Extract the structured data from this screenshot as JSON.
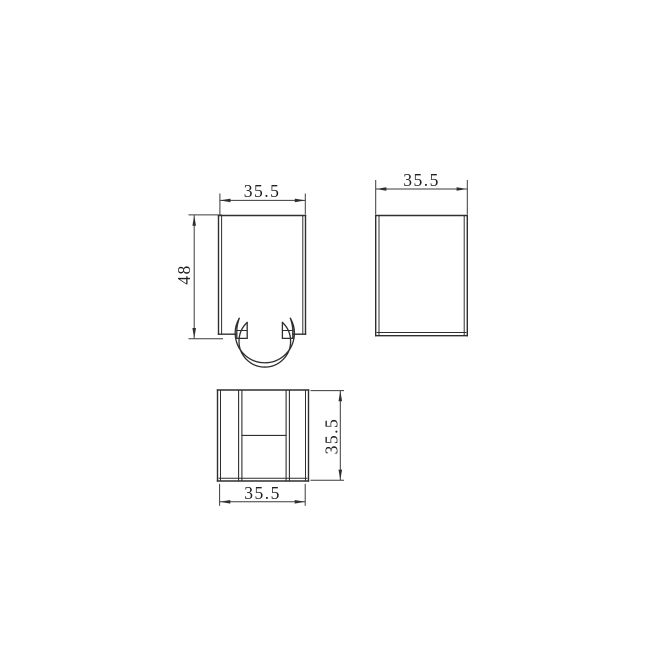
{
  "drawing": {
    "background": "#ffffff",
    "line_color": "#2f2f2f",
    "dim_color": "#3a3a3a",
    "views": {
      "front": {
        "width": "35.5",
        "height": "48"
      },
      "side": {
        "width": "35.5"
      },
      "bottom": {
        "width": "35.5",
        "height": "35.5"
      }
    }
  }
}
